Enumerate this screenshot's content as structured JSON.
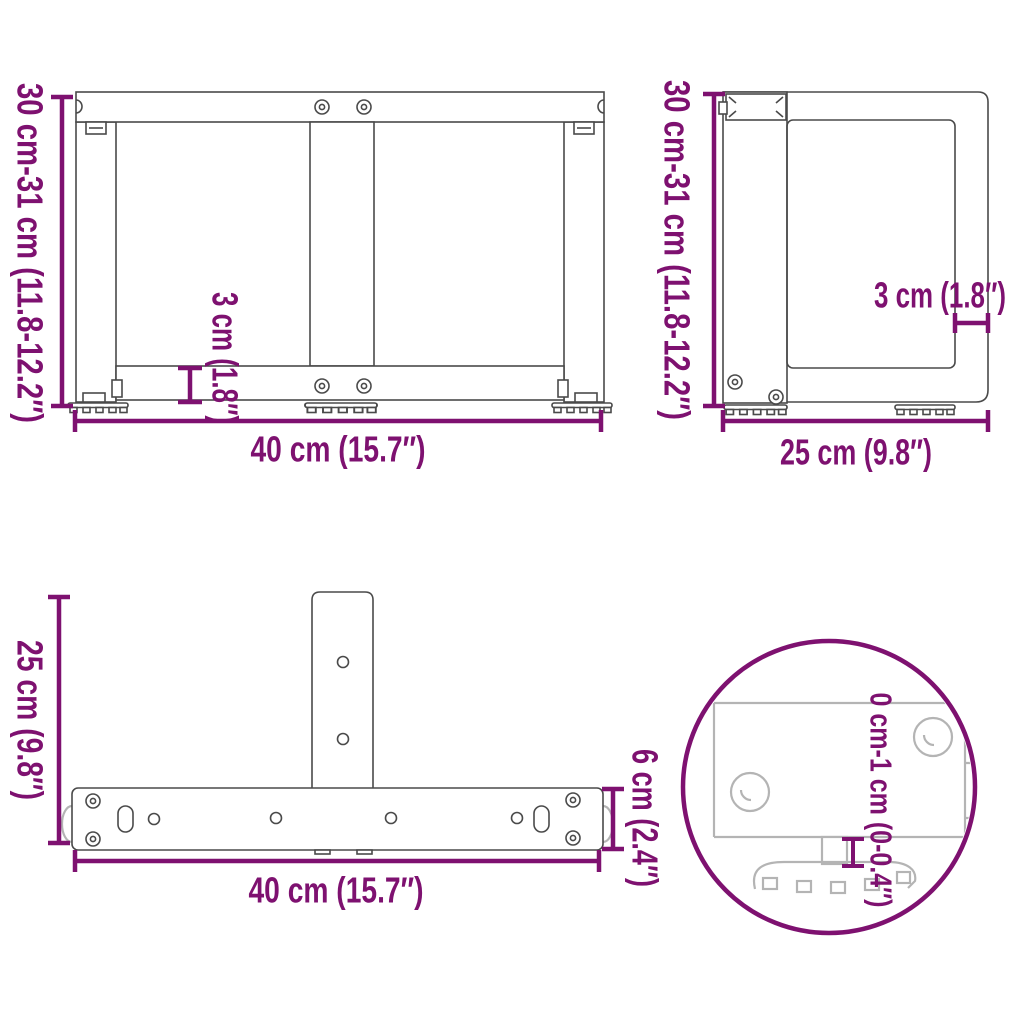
{
  "document": {
    "type": "product-dimension-diagram",
    "subject": "T-shaped table leg technical drawing, four views"
  },
  "colors": {
    "accent": "#7E1170",
    "object_line": "#4a4a4a",
    "ghost_line": "#b4b4b4",
    "background": "#ffffff"
  },
  "views": {
    "front": {
      "name": "front view",
      "height_label": "30 cm-31 cm (11.8-12.2″)",
      "width_label": "40 cm (15.7″)",
      "thickness_label": "3 cm (1.8″)"
    },
    "side": {
      "name": "side view",
      "height_label": "30 cm-31 cm (11.8-12.2″)",
      "depth_label": "25 cm (9.8″)",
      "thickness_label": "3 cm (1.8″)"
    },
    "top": {
      "name": "top view",
      "depth_label": "25 cm (9.8″)",
      "width_label": "40 cm (15.7″)",
      "bar_width_label": "6 cm (2.4″)"
    },
    "detail": {
      "name": "adjustable foot detail",
      "adjust_label": "0 cm-1 cm (0-0.4″)"
    }
  }
}
